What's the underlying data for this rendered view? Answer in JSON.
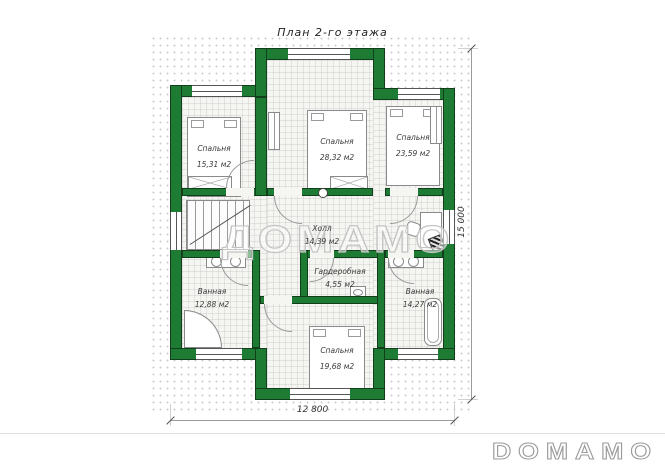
{
  "title": "План 2-го этажа",
  "watermark": "ДОМАМО",
  "logo": "DOMAMO",
  "dimensions": {
    "bottom": "12 800",
    "right": "15 000"
  },
  "rooms": {
    "bedroom_tl": {
      "name": "Спальня",
      "area": "15,31 м2"
    },
    "bedroom_tc": {
      "name": "Спальня",
      "area": "28,32 м2"
    },
    "bedroom_tr": {
      "name": "Спальня",
      "area": "23,59 м2"
    },
    "hall": {
      "name": "Холл",
      "area": "14,39 м2"
    },
    "bath_left": {
      "name": "Ванная",
      "area": "12,88 м2"
    },
    "wardrobe": {
      "name": "Гардеробная",
      "area": "4,55 м2"
    },
    "bath_right": {
      "name": "Ванная",
      "area": "14,27 м2"
    },
    "bedroom_b": {
      "name": "Спальня",
      "area": "19,68 м2"
    }
  },
  "colors": {
    "wall": "#1e7b33",
    "wall_outline": "#123e1c"
  }
}
